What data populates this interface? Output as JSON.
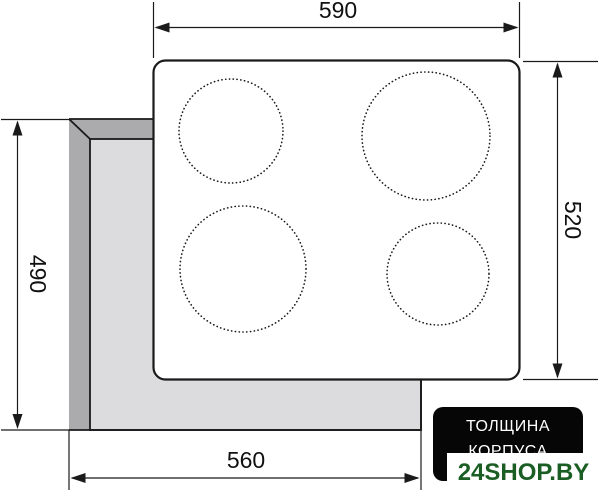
{
  "drawing": {
    "title": "cooktop-installation-dimensions",
    "dimensions": {
      "top": "590",
      "right": "520",
      "left": "490",
      "bottom": "560"
    },
    "burners": [
      {
        "position": "top-left",
        "cx": 231,
        "cy": 131,
        "r": 52
      },
      {
        "position": "top-right",
        "cx": 426,
        "cy": 136,
        "r": 64
      },
      {
        "position": "bottom-left",
        "cx": 243,
        "cy": 269,
        "r": 63
      },
      {
        "position": "bottom-right",
        "cx": 438,
        "cy": 274,
        "r": 51
      }
    ]
  },
  "thickness_badge": {
    "line1": "ТОЛЩИНА",
    "line2": "КОРПУСА"
  },
  "watermark": {
    "text": "24SHOP.BY"
  },
  "colors": {
    "line_black": "#1a1a1a",
    "body_outer_gray": "#ababad",
    "body_inner_gray": "#dcdcde",
    "panel_white": "#ffffff",
    "badge_bg": "#060606",
    "badge_text": "#ffffff",
    "watermark_green": "#1b5e24"
  }
}
